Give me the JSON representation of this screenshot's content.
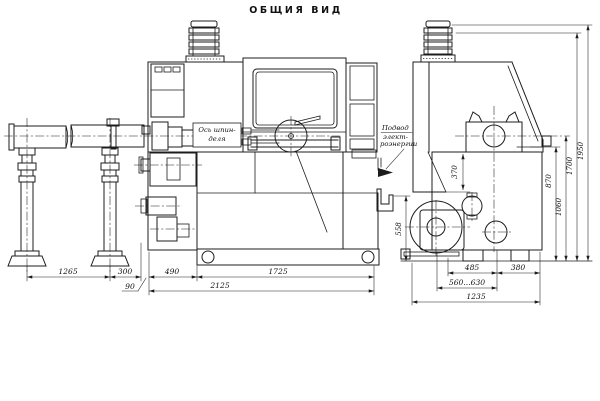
{
  "title": "ОБЩИЯ ВИД",
  "labels": {
    "spindle_axis": [
      "Ось шпин-",
      "деля"
    ],
    "power_supply": [
      "Подвод",
      "элект-",
      "роэнергии"
    ]
  },
  "dims": {
    "d1265": "1265",
    "d300": "300",
    "d90": "90",
    "d490": "490",
    "d1725": "1725",
    "d2125": "2125",
    "d558": "558",
    "d370": "370",
    "d870": "870",
    "d1060": "1060",
    "d1700": "1700",
    "d1950": "1950",
    "d485": "485",
    "d380": "380",
    "d560_630": "560...630",
    "d1235": "1235"
  },
  "colors": {
    "ink": "#1c1c1c",
    "paper": "#ffffff"
  }
}
